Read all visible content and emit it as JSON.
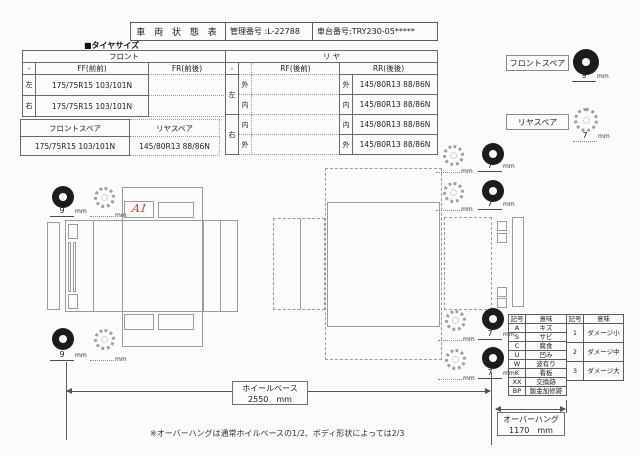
{
  "document": {
    "title": "車 両 状 態 表",
    "mgmt_label": "管理番号 :",
    "mgmt_value": "L-22788",
    "chassis_label": "車台番号:",
    "chassis_value": "TRY230-05*****"
  },
  "tire_size": {
    "section_label": "■タイヤサイズ",
    "front": {
      "title": "フロント",
      "corner": "-",
      "col_ff": "FF(前前)",
      "col_fr": "FR(前後)",
      "rows": [
        {
          "side": "左",
          "ff": "175/75R15 103/101N",
          "fr": ""
        },
        {
          "side": "右",
          "ff": "175/75R15 103/101N",
          "fr": ""
        }
      ]
    },
    "rear": {
      "title": "リ ヤ",
      "corner": "-",
      "col_rf": "RF(後前)",
      "col_rr": "RR(後後)",
      "rows": [
        {
          "side": "左",
          "pos": "外",
          "rf": "",
          "rr": "145/80R13 88/86N"
        },
        {
          "side": "左",
          "pos": "内",
          "rf": "",
          "rr": "145/80R13 88/86N"
        },
        {
          "side": "右",
          "pos": "内",
          "rf": "",
          "rr": "145/80R13 88/86N"
        },
        {
          "side": "右",
          "pos": "外",
          "rf": "",
          "rr": "145/80R13 88/86N"
        }
      ]
    },
    "spare": {
      "front_label": "フロントスペア",
      "front_value": "175/75R15 103/101N",
      "rear_label": "リヤスペア",
      "rear_value": "145/80R13 88/86N"
    }
  },
  "spare_indicators": {
    "front_label": "フロントスペア",
    "front_depth": "9",
    "rear_label": "リヤスペア",
    "rear_depth": "7",
    "unit": "mm"
  },
  "front_diagram": {
    "damage_mark": "A1",
    "unit": "mm",
    "tires": [
      {
        "outer": "9",
        "inner": ""
      },
      {
        "outer": "9",
        "inner": ""
      }
    ]
  },
  "rear_diagram": {
    "unit": "mm",
    "wheels": [
      {
        "inner_depth": "",
        "outer_depth": "7"
      },
      {
        "inner_depth": "",
        "outer_depth": "7"
      },
      {
        "inner_depth": "",
        "outer_depth": "7"
      },
      {
        "inner_depth": "",
        "outer_depth": "7"
      }
    ]
  },
  "legend": {
    "code_header": "記号",
    "meaning_header": "意味",
    "damage_codes": [
      {
        "code": "A",
        "meaning": "キズ"
      },
      {
        "code": "S",
        "meaning": "サビ"
      },
      {
        "code": "C",
        "meaning": "腐食"
      },
      {
        "code": "U",
        "meaning": "凹み"
      },
      {
        "code": "W",
        "meaning": "波有り"
      },
      {
        "code": "K",
        "meaning": "看板"
      },
      {
        "code": "XX",
        "meaning": "交換跡"
      },
      {
        "code": "BP",
        "meaning": "鈑金加修跡"
      }
    ],
    "severity_codes": [
      {
        "code": "1",
        "meaning": "ダメージ小"
      },
      {
        "code": "2",
        "meaning": "ダメージ中"
      },
      {
        "code": "3",
        "meaning": "ダメージ大"
      }
    ]
  },
  "measurements": {
    "wheelbase_label": "ホイールベース",
    "wheelbase_value": "2550",
    "overhang_label": "オーバーハング",
    "overhang_value": "1170",
    "unit": "mm",
    "footnote": "※オーバーハングは通常ホイルベースの1/2、ボディ形状によっては2/3"
  }
}
